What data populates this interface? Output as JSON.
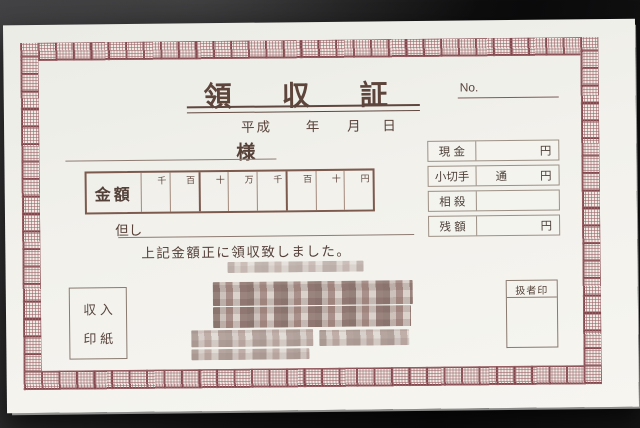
{
  "receipt": {
    "title": "領収証",
    "number": {
      "label": "No.",
      "value": ""
    },
    "date": {
      "era": "平成",
      "year_suffix": "年",
      "month_suffix": "月",
      "day_suffix": "日"
    },
    "addressee_suffix": "様",
    "amount": {
      "label": "金額",
      "digits": [
        "千",
        "百",
        "十",
        "万",
        "千",
        "百",
        "十",
        "円"
      ]
    },
    "proviso_label": "但し",
    "statement": "上記金額正に領収致しました。",
    "breakdown": {
      "rows": [
        {
          "label": "現 金",
          "unit": "",
          "currency": "円"
        },
        {
          "label": "小切手",
          "unit": "通",
          "currency": "円"
        },
        {
          "label": "相 殺",
          "unit": "",
          "currency": ""
        },
        {
          "label": "残 額",
          "unit": "",
          "currency": "円"
        }
      ]
    },
    "revenue_stamp": {
      "line1": "収 入",
      "line2": "印 紙"
    },
    "handler_seal": {
      "label": "扱者印"
    },
    "issuer": {
      "redacted": true
    }
  },
  "colors": {
    "ornament_border": "#82474d",
    "ink": "#59433b",
    "paper": "#f2f1ec",
    "desk": "#121213",
    "grid_line": "#a1887a"
  }
}
